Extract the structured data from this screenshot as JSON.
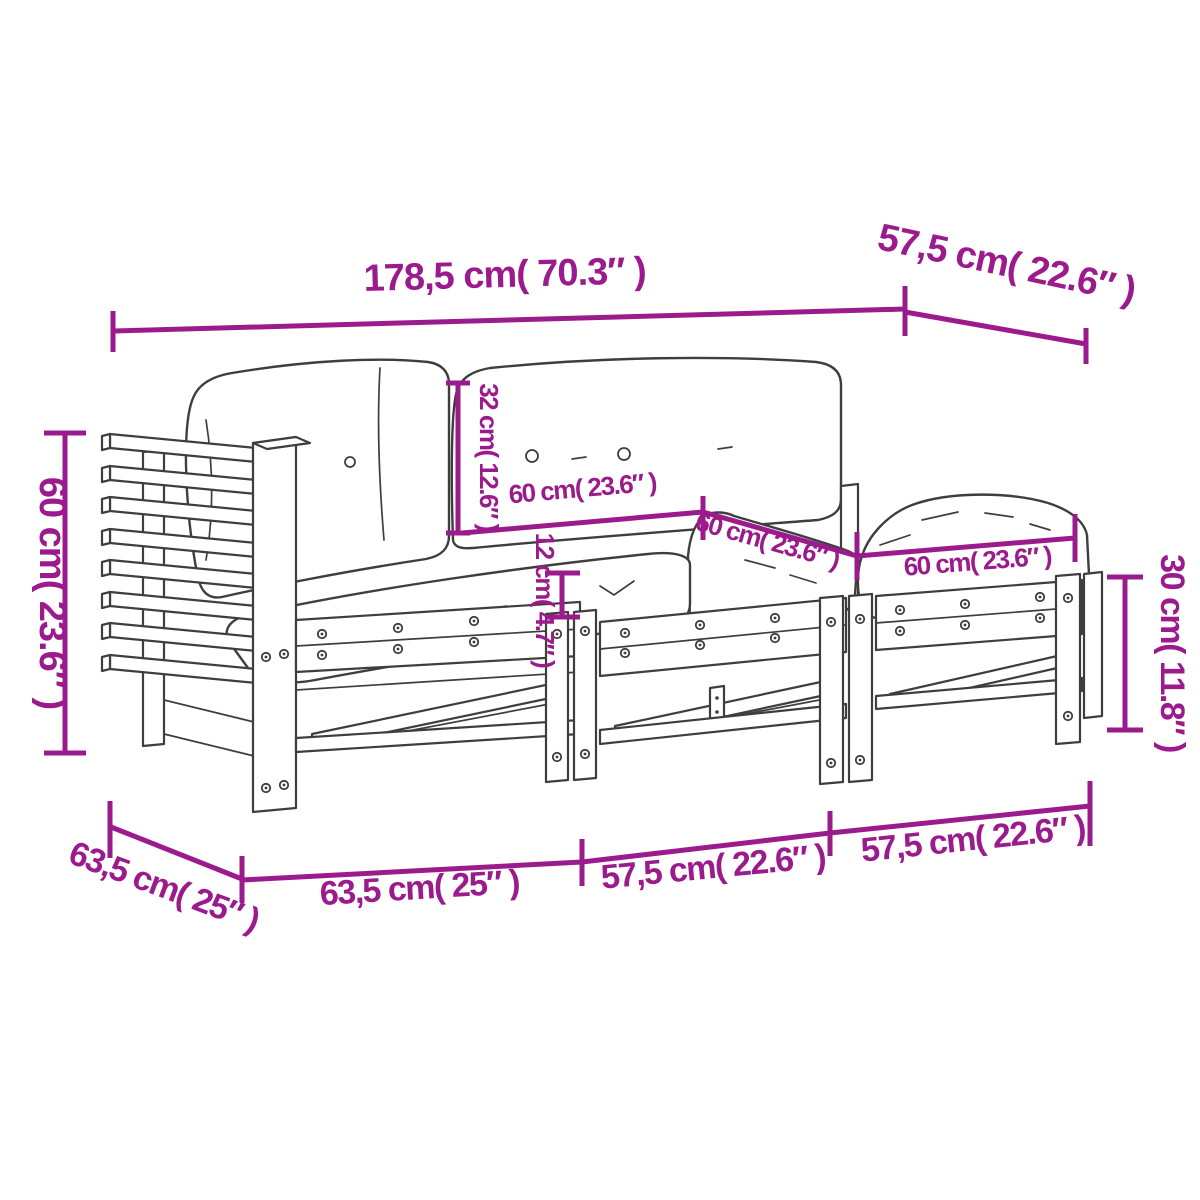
{
  "diagram": {
    "accent_color": "#9b1b8d",
    "line_color": "#3e3e3e",
    "subject": "3-piece wooden garden lounge set with cushions",
    "labels": {
      "overall_width": "178,5 cm( 70.3″ )",
      "overall_depth": "57,5 cm( 22.6″ )",
      "overall_height": "60 cm( 23.6″ )",
      "back_cushion_height": "32 cm( 12.6″ )",
      "back_cushion_width": "60 cm( 23.6″ )",
      "seat_cushion_depth": "60 cm( 23.6″ )",
      "stool_cushion_width": "60 cm( 23.6″ )",
      "seat_cushion_thickness": "12 cm( 4.7″ )",
      "stool_height": "30 cm( 11.8″ )",
      "base_depth": "63,5 cm( 25″ )",
      "corner_section_width": "63,5 cm( 25″ )",
      "middle_section_width": "57,5 cm( 22.6″ )",
      "stool_section_width": "57,5 cm( 22.6″ )"
    }
  }
}
